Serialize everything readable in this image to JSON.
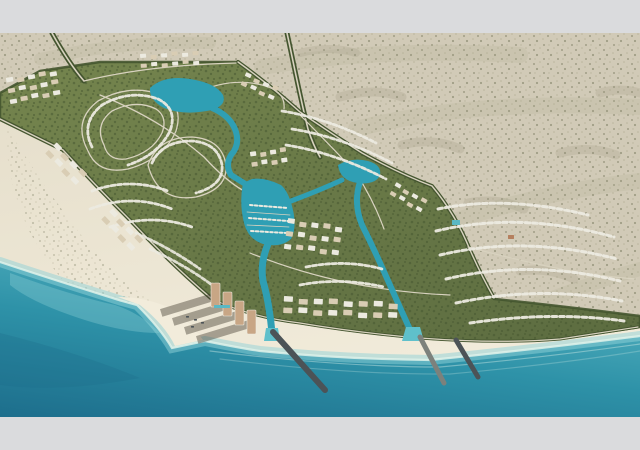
{
  "page": {
    "letterbox_color": "#dadbdd"
  },
  "colors": {
    "letterbox": "#dadbdd",
    "desert_base": "#d1cab7",
    "desert_speckle1": "#94927a",
    "desert_speckle2": "#b3ae95",
    "desert_streak": "#a9a58b",
    "beach": "#e6dfcc",
    "beach_light": "#f2ecdb",
    "sea_deep": "#1d6e8c",
    "sea_mid": "#2e92a8",
    "sea_shore": "#55b2c0",
    "sea_light": "#8fd2d8",
    "shore_foam": "#dff2ea",
    "canal": "#2f9fb4",
    "canal_light": "#5fc0cb",
    "dev_green": "#75854e",
    "dev_green_dark": "#5c6c40",
    "tree": "#44552f",
    "road_light": "#d8d2bf",
    "villa_white": "#eceae0",
    "villa_tan": "#d9cdb4",
    "building_terracotta": "#b5805f",
    "tower": "#c8a685",
    "shadow": "rgba(62,56,44,0.42)",
    "pier": "#4c5357",
    "jetty": "#7c817c",
    "pool": "#5ab8c4"
  },
  "scene": {
    "viewbox": "0 0 640 384",
    "layers": [
      {
        "name": "desert-base",
        "d": "M0,0H640V384H0Z",
        "fill": "desert_base"
      },
      {
        "name": "desert-speckle-texture",
        "d": "M0,0H640V384H0Z",
        "fill": "url:speckle",
        "opacity": 0.8
      },
      {
        "name": "desert-streak",
        "d": "M-10,118 Q70,70 160,42",
        "stroke": "desert_streak",
        "w": 14,
        "opacity": 0.18
      },
      {
        "name": "desert-streak",
        "d": "M-8,196 Q86,148 176,108",
        "stroke": "desert_streak",
        "w": 14,
        "opacity": 0.18
      },
      {
        "name": "desert-streak",
        "d": "M40,26 Q120,8 210,10",
        "stroke": "desert_streak",
        "w": 12,
        "opacity": 0.16
      },
      {
        "name": "desert-streak",
        "d": "M262,34 Q380,14 520,22",
        "stroke": "desert_streak",
        "w": 16,
        "opacity": 0.16
      },
      {
        "name": "desert-streak",
        "d": "M356,96 Q470,66 640,74",
        "stroke": "desert_streak",
        "w": 16,
        "opacity": 0.16
      },
      {
        "name": "desert-streak",
        "d": "M430,196 Q540,158 640,148",
        "stroke": "desert_streak",
        "w": 16,
        "opacity": 0.16
      },
      {
        "name": "desert-streak",
        "d": "M470,300 Q560,258 640,236",
        "stroke": "desert_streak",
        "w": 14,
        "opacity": 0.16
      },
      {
        "name": "desert-mottle",
        "d": "M340,64 q34,-10 62,0",
        "stroke": "desert_speckle1",
        "w": 9,
        "opacity": 0.22
      },
      {
        "name": "desert-mottle",
        "d": "M402,112 q30,-8 58,4",
        "stroke": "desert_speckle1",
        "w": 9,
        "opacity": 0.22
      },
      {
        "name": "desert-mottle",
        "d": "M468,170 q30,-6 56,6",
        "stroke": "desert_speckle1",
        "w": 9,
        "opacity": 0.22
      },
      {
        "name": "desert-mottle",
        "d": "M520,238 q28,-4 54,8",
        "stroke": "desert_speckle1",
        "w": 9,
        "opacity": 0.2
      },
      {
        "name": "desert-mottle",
        "d": "M560,120 q30,-8 56,2",
        "stroke": "desert_speckle1",
        "w": 9,
        "opacity": 0.2
      },
      {
        "name": "desert-mottle",
        "d": "M600,60 q20,-6 40,0",
        "stroke": "desert_speckle1",
        "w": 9,
        "opacity": 0.2
      },
      {
        "name": "desert-mottle",
        "d": "M300,20 q30,-8 56,0",
        "stroke": "desert_speckle1",
        "w": 8,
        "opacity": 0.2
      },
      {
        "name": "beach-sand",
        "d": "M0,85 L63,117 Q95,152 130,187 Q170,230 212,266 Q250,284 300,290 Q360,300 420,305 Q500,311 560,306 Q600,300 640,294 L640,384 L0,384 Z",
        "fill": "url:beachGrad"
      },
      {
        "name": "beach-scrub",
        "d": "M6,92 Q40,150 86,208 Q116,244 156,272 L120,300 Q60,256 28,196 Q4,140 6,92 Z",
        "fill": "url:speckle",
        "opacity": 0.45
      },
      {
        "name": "ocean",
        "d": "M0,229 C60,249 100,261 122,268 L137,272 Q160,295 172,315 L205,308 Q240,315 260,318 Q340,326 430,327 Q530,317 640,303 L640,384 L0,384 Z",
        "fill": "url:seaGrad"
      },
      {
        "name": "ocean-deep-patch",
        "d": "M0,300 Q80,320 140,345 Q60,360 0,352 Z",
        "fill": "sea_deep",
        "opacity": 0.3
      },
      {
        "name": "shore-shallows",
        "d": "M0,229 C60,249 100,261 122,268 L137,272 Q160,295 172,315 L205,308 Q240,315 260,318 Q340,326 430,327 Q530,317 640,303",
        "stroke": "sea_light",
        "w": 10,
        "opacity": 0.5
      },
      {
        "name": "shore-foam",
        "d": "M0,229 C60,249 100,261 122,268 L137,272 Q160,295 172,315 L205,308 Q240,315 260,318 Q340,326 430,327 Q530,317 640,303",
        "stroke": "shore_foam",
        "w": 2.2,
        "opacity": 0.85
      },
      {
        "name": "wave-line",
        "d": "M210,318 Q340,334 440,334 Q540,325 640,311",
        "stroke": "shore_foam",
        "w": 1.2,
        "opacity": 0.4
      },
      {
        "name": "wave-line",
        "d": "M220,326 Q350,342 450,341 Q560,331 640,318",
        "stroke": "shore_foam",
        "w": 1.2,
        "opacity": 0.25
      },
      {
        "name": "bay-shallow-patch",
        "d": "M10,240 Q70,262 115,272 Q140,280 160,300 Q120,300 70,282 Q30,268 10,252 Z",
        "fill": "sea_light",
        "opacity": 0.35
      },
      {
        "name": "sand-spit",
        "d": "M118,264 L140,272 Q165,292 175,313 L203,307 Q190,288 170,275 Q145,264 118,264 Z",
        "fill": "beach_light"
      },
      {
        "name": "development-area",
        "d": "M0,60 L40,38 L100,29 L238,29 Q270,52 300,79 Q335,103 362,120 Q400,141 432,153 Q456,182 470,217 Q482,244 495,266 Q550,272 600,278 L640,283 L640,294 Q600,300 560,306 Q500,311 420,305 Q360,300 300,290 Q250,284 212,266 Q170,230 130,187 Q95,152 63,117 L0,85 Z",
        "fill": "url:devGrad"
      },
      {
        "name": "development-foliage-texture",
        "d": "M0,60 L40,38 L100,29 L238,29 Q270,52 300,79 Q335,103 362,120 Q400,141 432,153 Q456,182 470,217 Q482,244 495,266 Q550,272 600,278 L640,283 L640,294 Q600,300 560,306 Q500,311 420,305 Q360,300 300,290 Q250,284 212,266 Q170,230 130,187 Q95,152 63,117 L0,85 Z",
        "fill": "url:foliage",
        "opacity": 0.5
      },
      {
        "name": "development-tree-edge",
        "d": "M0,60 L40,38 L100,29 L238,29 Q270,52 300,79 Q335,103 362,120 Q400,141 432,153 Q456,182 470,217 Q482,244 495,266 Q550,272 600,278 L640,283 L640,294 Q600,300 560,306 Q500,311 420,305 Q360,300 300,290 Q250,284 212,266 Q170,230 130,187 Q95,152 63,117 L0,85 Z",
        "stroke": "tree",
        "w": 2.5,
        "opacity": 0.9
      },
      {
        "name": "access-road-northwest-trees",
        "d": "M52,0 C62,18 72,34 84,48",
        "stroke": "tree",
        "w": 5
      },
      {
        "name": "access-road-northwest",
        "d": "M52,0 C62,18 72,34 84,48",
        "stroke": "road_light",
        "w": 1.6
      },
      {
        "name": "access-road-northeast-trees",
        "d": "M287,0 C294,32 300,64 308,96 Q313,112 320,124",
        "stroke": "tree",
        "w": 5
      },
      {
        "name": "access-road-northeast",
        "d": "M287,0 C294,32 300,64 308,96 Q313,112 320,124",
        "stroke": "road_light",
        "w": 1.6
      },
      {
        "name": "perimeter-road-ne-trees",
        "d": "M238,29 Q270,52 300,79 Q335,103 362,120 Q400,141 432,153 Q456,182 470,217 Q482,244 494,265",
        "stroke": "tree",
        "w": 4
      },
      {
        "name": "perimeter-road-ne",
        "d": "M238,29 Q270,52 300,79 Q335,103 362,120 Q400,141 432,153 Q456,182 470,217 Q482,244 494,265",
        "stroke": "road_light",
        "w": 1.4
      },
      {
        "name": "beachfront-road-west-trees",
        "d": "M0,86 L63,117 Q95,152 130,187 Q170,230 212,266",
        "stroke": "tree",
        "w": 4
      },
      {
        "name": "beachfront-road-west",
        "d": "M0,86 L63,117 Q95,152 130,187 Q170,230 212,266",
        "stroke": "road_light",
        "w": 1.4
      },
      {
        "name": "beachfront-road-south-trees",
        "d": "M212,266 Q250,284 300,290 Q360,300 420,305 Q500,311 560,306 Q600,300 638,294",
        "stroke": "tree",
        "w": 3
      },
      {
        "name": "beachfront-road-south",
        "d": "M212,266 Q250,284 300,290 Q360,300 420,305 Q500,311 560,306 Q600,300 638,294",
        "stroke": "road_light",
        "w": 1.2
      },
      {
        "name": "internal-road",
        "d": "M84,48 Q150,32 236,30",
        "stroke": "road_light",
        "w": 1.3
      },
      {
        "name": "internal-road",
        "d": "M100,62 Q160,86 204,124 Q226,148 244,158",
        "stroke": "road_light",
        "w": 1.3
      },
      {
        "name": "internal-road",
        "d": "M300,82 Q330,112 356,140 Q374,168 384,196",
        "stroke": "road_light",
        "w": 1.2
      },
      {
        "name": "internal-road",
        "d": "M468,214 Q520,228 570,238 Q608,244 636,246",
        "stroke": "road_light",
        "w": 1.2
      },
      {
        "name": "internal-road",
        "d": "M250,220 Q300,240 350,250 Q400,260 450,262",
        "stroke": "road_light",
        "w": 1.2
      },
      {
        "name": "street-loop",
        "d": "M88,118 Q72,88 98,68 Q130,50 162,62 Q184,72 176,98 Q164,126 128,136 Q98,142 88,118 Z",
        "stroke": "road_light",
        "w": 1.3
      },
      {
        "name": "street-loop",
        "d": "M104,112 Q94,92 112,78 Q136,66 156,76 Q168,84 162,100 Q152,120 126,126 Q108,128 104,112 Z",
        "stroke": "road_light",
        "w": 1.3
      },
      {
        "name": "street-loop",
        "d": "M148,132 Q158,104 192,104 Q222,106 226,132 Q228,156 196,164 Q158,170 148,132 Z",
        "stroke": "road_light",
        "w": 1.3
      },
      {
        "name": "street-arc",
        "d": "M196,60 Q230,44 262,52 Q286,58 284,76",
        "stroke": "road_light",
        "w": 1.2
      },
      {
        "name": "lagoon-west",
        "d": "M150,55 Q164,42 190,46 Q216,50 223,62 Q227,72 212,77 Q184,83 164,75 Q149,67 150,55 Z",
        "fill": "canal"
      },
      {
        "name": "lagoon-east",
        "d": "M338,132 Q352,124 368,128 Q382,132 380,142 Q376,152 358,150 Q340,148 338,132 Z",
        "fill": "canal"
      },
      {
        "name": "canal-west",
        "d": "M212,75 Q231,83 236,99 Q240,112 231,122 Q225,132 231,142 L247,152",
        "stroke": "canal",
        "w": 6,
        "cap": "round"
      },
      {
        "name": "marina-basin",
        "d": "M243,150 Q239,170 244,190 Q248,206 263,211 Q281,215 291,206 Q297,195 293,177 Q289,159 281,152 Q265,144 252,146 Z",
        "fill": "canal"
      },
      {
        "name": "canal-south",
        "d": "M268,211 Q260,230 263,248 Q267,262 269,276 Q271,288 272,300",
        "stroke": "canal",
        "w": 7,
        "cap": "round"
      },
      {
        "name": "canal-connector",
        "d": "M291,168 Q318,158 342,147",
        "stroke": "canal",
        "w": 5,
        "cap": "round"
      },
      {
        "name": "canal-east",
        "d": "M360,149 Q353,170 362,192 Q372,212 381,232 Q390,252 398,270 Q406,288 413,303",
        "stroke": "canal",
        "w": 6,
        "cap": "round"
      },
      {
        "name": "canal-outlet-west",
        "d": "M266,295 L278,295 L280,308 L264,308 Z",
        "fill": "canal_light"
      },
      {
        "name": "canal-outlet-east",
        "d": "M406,294 L420,294 L424,308 L402,308 Z",
        "fill": "canal_light"
      },
      {
        "name": "marina-dock",
        "d": "M247,179 L290,182",
        "stroke": "road_light",
        "w": 0.8
      },
      {
        "name": "marina-dock",
        "d": "M247,192 L289,194",
        "stroke": "road_light",
        "w": 0.8
      },
      {
        "name": "marina-boats-row",
        "d": "M250,172 L288,175",
        "stroke": "villa_white",
        "w": 2,
        "dash": "2.6 2.2"
      },
      {
        "name": "marina-boats-row",
        "d": "M249,185 L288,188",
        "stroke": "villa_white",
        "w": 2,
        "dash": "2.6 2.2"
      },
      {
        "name": "marina-boats-row",
        "d": "M251,198 L287,200",
        "stroke": "villa_white",
        "w": 2,
        "dash": "2.6 2.2"
      },
      {
        "name": "villa-row",
        "d": "M92,114 Q80,90 102,72 Q130,56 158,66 Q178,76 170,98 Q158,122 128,132",
        "stroke": "villa_white",
        "w": 2.8,
        "dash": "4 2.6",
        "opacity": 0.95
      },
      {
        "name": "villa-row",
        "d": "M152,130 Q162,108 192,108 Q218,110 222,132 Q224,152 196,160",
        "stroke": "villa_white",
        "w": 2.8,
        "dash": "4 2.6",
        "opacity": 0.95
      },
      {
        "name": "villa-row",
        "d": "M92,158 Q130,144 168,158",
        "stroke": "villa_white",
        "w": 2.8,
        "dash": "4 2.6",
        "opacity": 0.95
      },
      {
        "name": "villa-row",
        "d": "M90,176 Q132,160 172,176",
        "stroke": "villa_white",
        "w": 2.8,
        "dash": "4 2.6",
        "opacity": 0.95
      },
      {
        "name": "villa-row",
        "d": "M110,194 Q152,180 192,194",
        "stroke": "villa_white",
        "w": 2.8,
        "dash": "4 2.6",
        "opacity": 0.95
      },
      {
        "name": "villa-row",
        "d": "M150,216 Q185,232 212,252",
        "stroke": "villa_white",
        "w": 2.8,
        "dash": "4 2.6",
        "opacity": 0.9
      },
      {
        "name": "villa-row",
        "d": "M136,200 Q172,216 200,236",
        "stroke": "villa_white",
        "w": 2.8,
        "dash": "4 2.6",
        "opacity": 0.9
      },
      {
        "name": "villa-row",
        "d": "M282,78 Q330,86 376,110",
        "stroke": "villa_white",
        "w": 2.8,
        "dash": "4 2.6",
        "opacity": 0.95
      },
      {
        "name": "villa-row",
        "d": "M292,96 Q342,104 392,130",
        "stroke": "villa_white",
        "w": 2.8,
        "dash": "4 2.6",
        "opacity": 0.95
      },
      {
        "name": "villa-row",
        "d": "M286,112 Q336,120 386,146",
        "stroke": "villa_white",
        "w": 2.8,
        "dash": "4 2.6",
        "opacity": 0.95
      },
      {
        "name": "villa-row",
        "d": "M438,176 Q506,162 588,182",
        "stroke": "villa_white",
        "w": 3,
        "dash": "4.5 3",
        "opacity": 0.95
      },
      {
        "name": "villa-row",
        "d": "M436,198 Q520,178 614,204",
        "stroke": "villa_white",
        "w": 3,
        "dash": "4.5 3",
        "opacity": 0.95
      },
      {
        "name": "villa-row",
        "d": "M440,222 Q524,202 617,226",
        "stroke": "villa_white",
        "w": 3,
        "dash": "4.5 3",
        "opacity": 0.95
      },
      {
        "name": "villa-row",
        "d": "M446,246 Q530,226 620,248",
        "stroke": "villa_white",
        "w": 3,
        "dash": "4.5 3",
        "opacity": 0.95
      },
      {
        "name": "villa-row",
        "d": "M456,270 Q540,252 622,268",
        "stroke": "villa_white",
        "w": 3,
        "dash": "4.5 3",
        "opacity": 0.95
      },
      {
        "name": "villa-row",
        "d": "M470,290 Q552,278 624,288",
        "stroke": "villa_white",
        "w": 3,
        "dash": "4.5 3",
        "opacity": 0.95
      },
      {
        "name": "villa-row",
        "d": "M300,252 Q340,244 384,254",
        "stroke": "villa_white",
        "w": 2.8,
        "dash": "4 2.6",
        "opacity": 0.95
      },
      {
        "name": "villa-row",
        "d": "M306,234 Q346,226 382,236",
        "stroke": "villa_white",
        "w": 2.8,
        "dash": "4 2.6",
        "opacity": 0.95
      },
      {
        "name": "breakwater-pier-west",
        "d": "M273,299 L325,357",
        "stroke": "pier",
        "w": 6
      },
      {
        "name": "rock-jetty-middle",
        "d": "M420,304 L444,350",
        "stroke": "jetty",
        "w": 5
      },
      {
        "name": "breakwater-pier-east",
        "d": "M456,307 L478,344",
        "stroke": "pier",
        "w": 5
      }
    ],
    "clusters": [
      {
        "name": "west-midrise-cluster",
        "x": 6,
        "y": 46,
        "angle": -10,
        "rows": 3,
        "cols": 5,
        "bw": 7,
        "bh": 4.5,
        "gx": 4,
        "gy": 5.5
      },
      {
        "name": "north-central-blocks",
        "x": 140,
        "y": 22,
        "angle": -4,
        "rows": 2,
        "cols": 6,
        "bw": 6,
        "bh": 4,
        "gx": 4.5,
        "gy": 5
      },
      {
        "name": "northeast-blocks",
        "x": 246,
        "y": 40,
        "angle": 25,
        "rows": 2,
        "cols": 4,
        "bw": 6,
        "bh": 4,
        "gx": 4,
        "gy": 5
      },
      {
        "name": "west-edge-blocks-a",
        "x": 56,
        "y": 110,
        "angle": 46,
        "rows": 2,
        "cols": 4,
        "bw": 8,
        "bh": 5,
        "gx": 4,
        "gy": 5
      },
      {
        "name": "west-edge-blocks-b",
        "x": 112,
        "y": 176,
        "angle": 46,
        "rows": 2,
        "cols": 4,
        "bw": 8,
        "bh": 5,
        "gx": 4,
        "gy": 5
      },
      {
        "name": "marina-village-blocks",
        "x": 250,
        "y": 120,
        "angle": -8,
        "rows": 2,
        "cols": 4,
        "bw": 6,
        "bh": 4.5,
        "gx": 4,
        "gy": 5
      },
      {
        "name": "central-mixed-blocks",
        "x": 288,
        "y": 186,
        "angle": 8,
        "rows": 3,
        "cols": 5,
        "bw": 7,
        "bh": 5,
        "gx": 5,
        "gy": 7
      },
      {
        "name": "beach-resort-strip",
        "x": 284,
        "y": 264,
        "angle": 3,
        "rows": 2,
        "cols": 8,
        "bw": 9,
        "bh": 5.5,
        "gx": 6,
        "gy": 5
      },
      {
        "name": "east-canal-villas",
        "x": 396,
        "y": 150,
        "angle": 30,
        "rows": 2,
        "cols": 4,
        "bw": 6,
        "bh": 4,
        "gx": 4,
        "gy": 5
      }
    ],
    "towers": {
      "name": "beachfront-towers",
      "w": 9,
      "h": 24,
      "shadow_len": 54,
      "shadow_h": 8,
      "shadow_angle": 163,
      "positions": [
        [
          211,
          250
        ],
        [
          223,
          259
        ],
        [
          235,
          268
        ],
        [
          247,
          277
        ]
      ]
    },
    "marks": [
      {
        "name": "spit-boat-mark",
        "x": 186,
        "y": 283,
        "w": 3,
        "h": 1.6,
        "color": "pier"
      },
      {
        "name": "spit-boat-mark",
        "x": 194,
        "y": 286,
        "w": 3,
        "h": 1.6,
        "color": "pier"
      },
      {
        "name": "spit-boat-mark",
        "x": 201,
        "y": 289,
        "w": 3,
        "h": 1.6,
        "color": "pier"
      },
      {
        "name": "spit-boat-mark",
        "x": 191,
        "y": 293,
        "w": 3,
        "h": 1.6,
        "color": "pier"
      },
      {
        "name": "terracotta-building",
        "x": 508,
        "y": 202,
        "w": 6,
        "h": 4,
        "color": "building_terracotta"
      },
      {
        "name": "villa-pool",
        "x": 452,
        "y": 187,
        "w": 8,
        "h": 5,
        "color": "pool"
      },
      {
        "name": "tower-pool-deck",
        "x": 214,
        "y": 272,
        "w": 16,
        "h": 3,
        "color": "pool"
      }
    ]
  }
}
